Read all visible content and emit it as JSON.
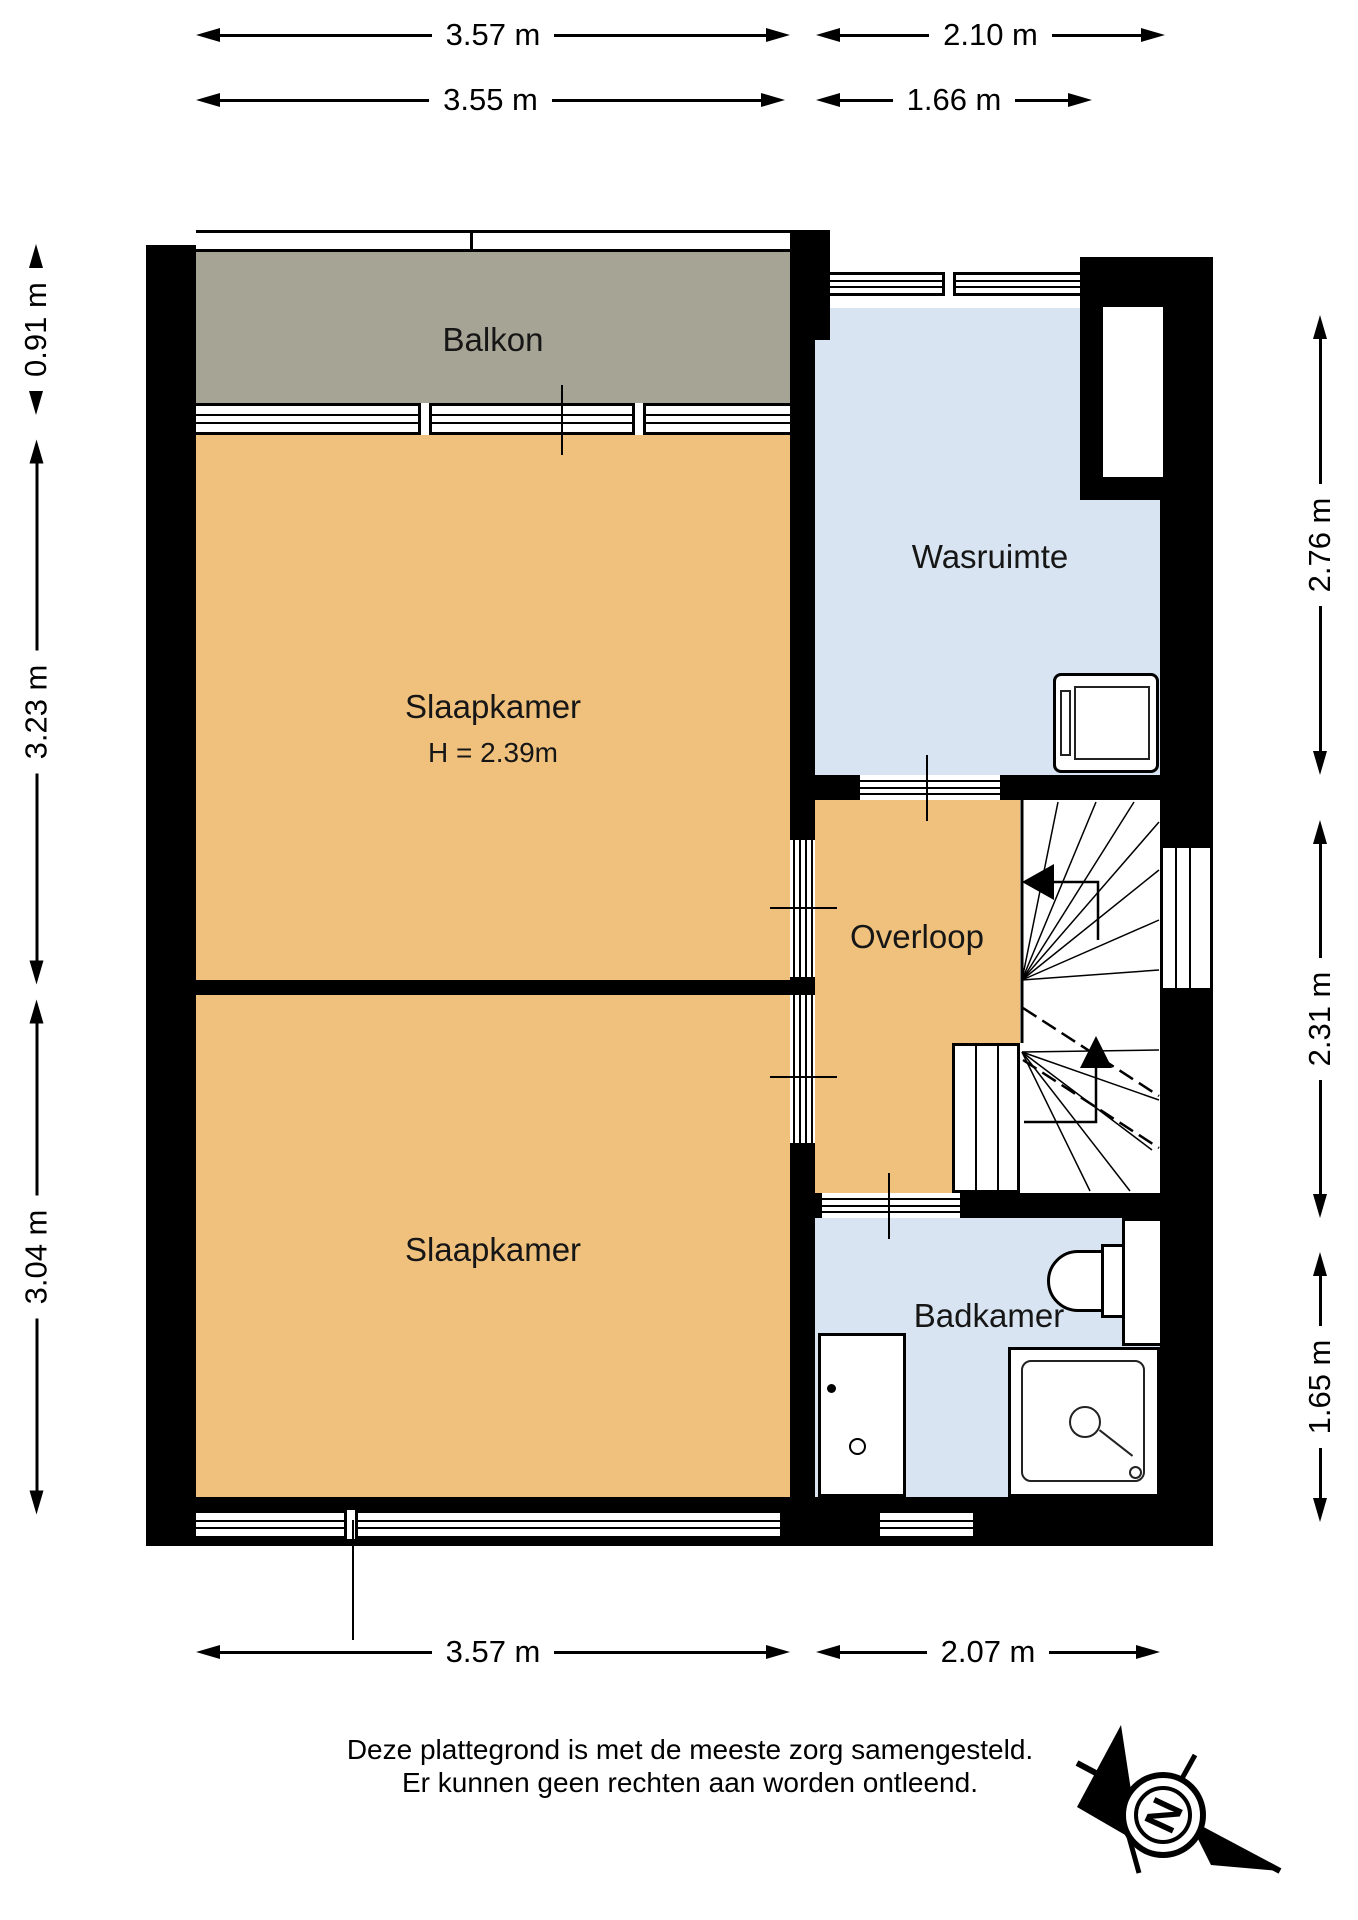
{
  "plan": {
    "rooms": {
      "balkon": {
        "label": "Balkon"
      },
      "slaapkamer_1": {
        "label": "Slaapkamer",
        "height_note": "H = 2.39m"
      },
      "wasruimte": {
        "label": "Wasruimte"
      },
      "overloop": {
        "label": "Overloop"
      },
      "slaapkamer_2": {
        "label": "Slaapkamer"
      },
      "badkamer": {
        "label": "Badkamer"
      }
    },
    "colors": {
      "room_orange": "#EFC17D",
      "room_blue": "#D8E4F1",
      "balkon_gray": "#A6A495",
      "wall_black": "#000000",
      "background": "#FFFFFF"
    }
  },
  "dimensions": {
    "top_outer_left": {
      "label": "3.57 m"
    },
    "top_outer_right": {
      "label": "2.10 m"
    },
    "top_inner_left": {
      "label": "3.55 m"
    },
    "top_inner_right": {
      "label": "1.66 m"
    },
    "left_balkon": {
      "label": "0.91 m"
    },
    "left_slaapkamer_1": {
      "label": "3.23 m"
    },
    "left_slaapkamer_2": {
      "label": "3.04 m"
    },
    "right_wasruimte": {
      "label": "2.76 m"
    },
    "right_overloop": {
      "label": "2.31 m"
    },
    "right_badkamer": {
      "label": "1.65 m"
    },
    "bottom_left": {
      "label": "3.57 m"
    },
    "bottom_right": {
      "label": "2.07 m"
    }
  },
  "footer": {
    "disclaimer_line_1": "Deze plattegrond is met de meeste zorg samengesteld.",
    "disclaimer_line_2": "Er kunnen geen rechten aan worden ontleend.",
    "compass_letter": "N"
  }
}
